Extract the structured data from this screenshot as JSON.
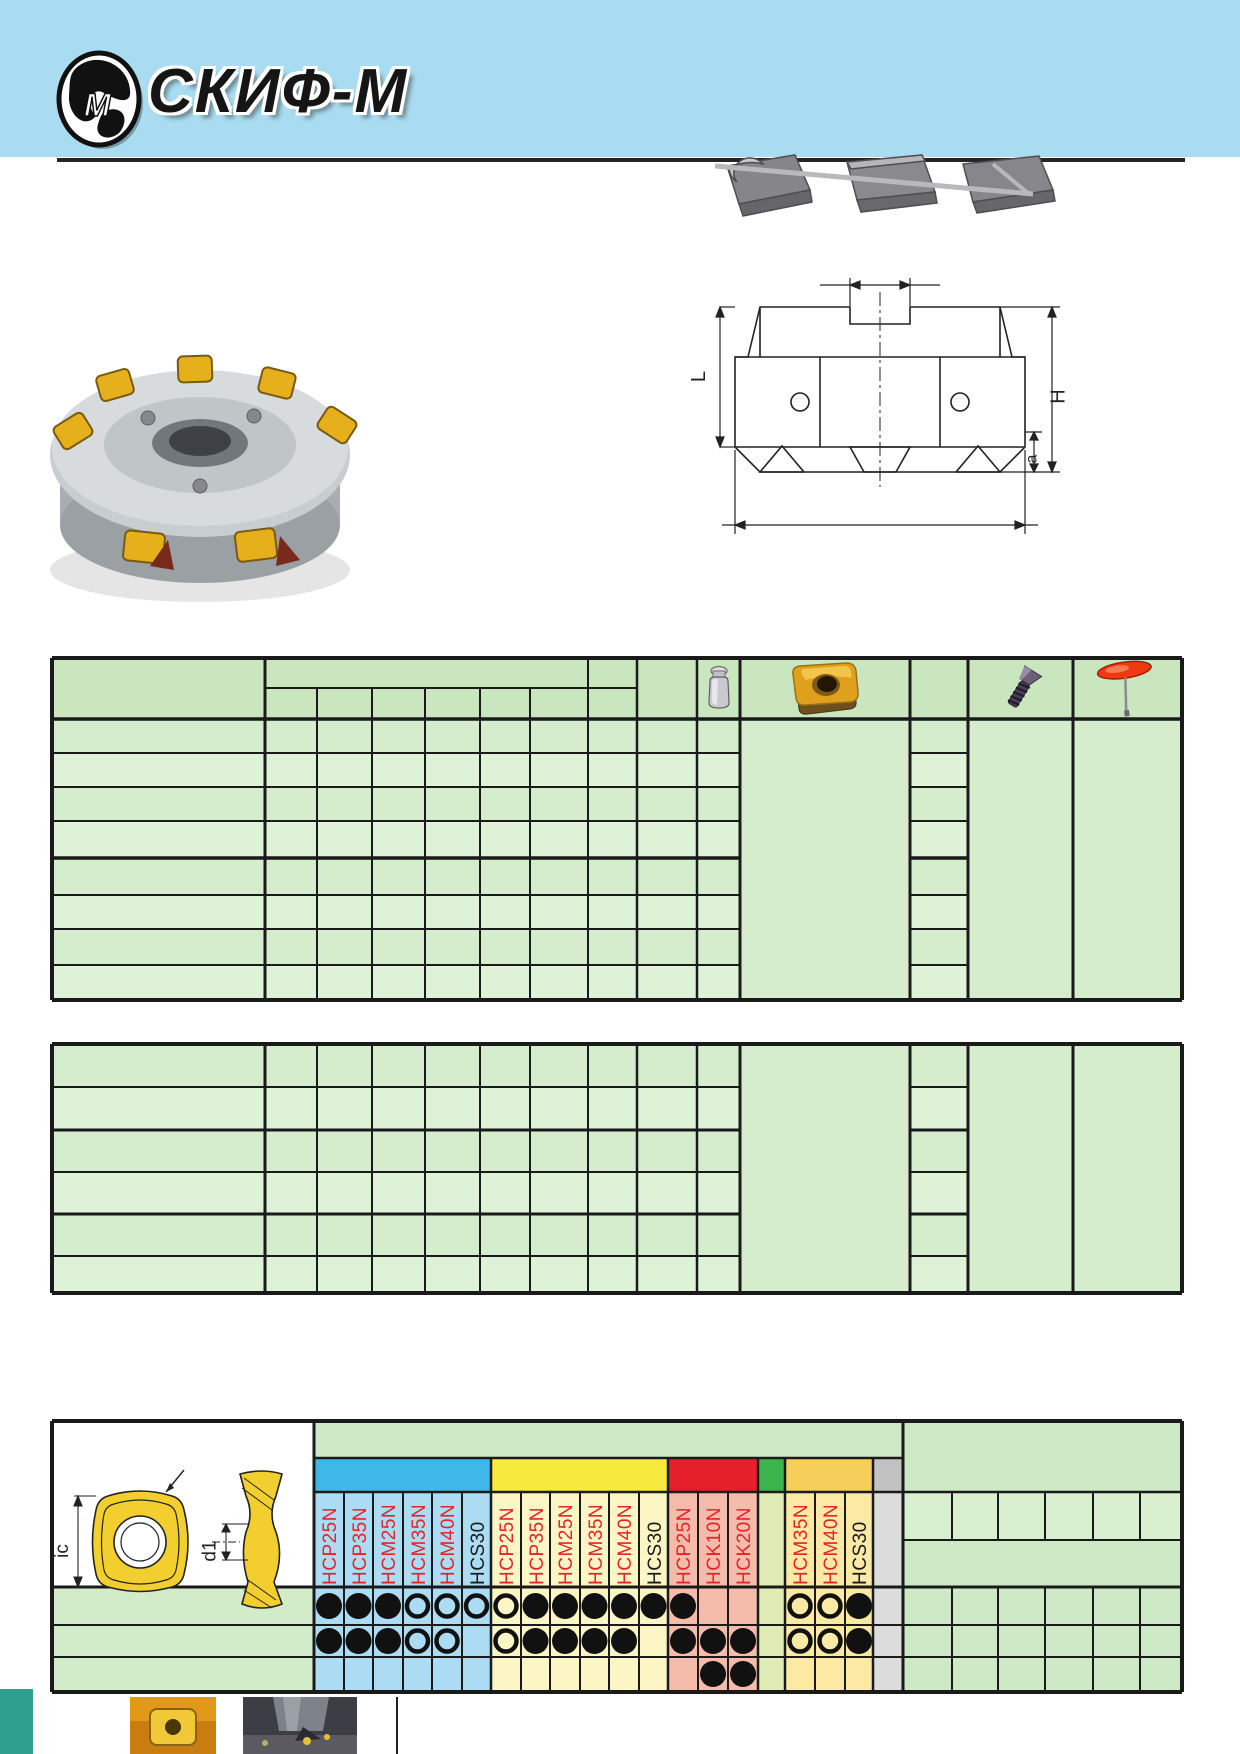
{
  "header": {
    "title": "СКИФ-М",
    "logo_letter": "M"
  },
  "images": {
    "carbide_inserts_photo": "three-carbide-inserts",
    "face_mill_photo": "face-mill-with-gold-inserts",
    "action_photo": "milling-in-action",
    "insert_photo_small": "square-gold-insert"
  },
  "tech_drawing": {
    "labels": {
      "L": "L",
      "H": "H",
      "a": "a"
    }
  },
  "insert_drawing": {
    "labels": {
      "ic": "ic",
      "d1": "d1"
    }
  },
  "table1": {
    "header_icons": [
      "weight-icon",
      "insert-photo-icon",
      "clamp-screw-icon",
      "torx-key-icon"
    ],
    "data_rows": 8
  },
  "table2": {
    "data_rows": 6
  },
  "grades_table": {
    "mark_legend": {
      "F": "filled-circle",
      "O": "open-circle",
      "": "none"
    },
    "black_label_grades": [
      "HCS30"
    ],
    "groups": [
      {
        "name": "blue",
        "band_color": "#3eb8e9",
        "cell_color": "#abdcf3",
        "grades": [
          "HCP25N",
          "HCP35N",
          "HCM25N",
          "HCM35N",
          "HCM40N",
          "HCS30"
        ]
      },
      {
        "name": "yellow",
        "band_color": "#f7ea3d",
        "cell_color": "#fbf6c3",
        "grades": [
          "HCP25N",
          "HCP35N",
          "HCM25N",
          "HCM35N",
          "HCM40N",
          "HCS30"
        ]
      },
      {
        "name": "red",
        "band_color": "#e5202b",
        "cell_color": "#f5bcab",
        "grades": [
          "HCP25N",
          "HCK10N",
          "HCK20N"
        ]
      },
      {
        "name": "green",
        "band_color": "#3cb64c",
        "cell_color": "#e0ecb6",
        "grades": [
          ""
        ]
      },
      {
        "name": "tan",
        "band_color": "#f6cf5b",
        "cell_color": "#fbe9a4",
        "grades": [
          "HCM35N",
          "HCM40N",
          "HCS30"
        ]
      },
      {
        "name": "gray",
        "band_color": "#c2c2c2",
        "cell_color": "#dcdcdc",
        "grades": [
          ""
        ]
      }
    ],
    "rows": [
      [
        "F",
        "F",
        "F",
        "O",
        "O",
        "O",
        "O",
        "F",
        "F",
        "F",
        "F",
        "F",
        "F",
        "",
        "",
        "",
        "O",
        "O",
        "F",
        ""
      ],
      [
        "F",
        "F",
        "F",
        "O",
        "O",
        "",
        "O",
        "F",
        "F",
        "F",
        "F",
        "",
        "F",
        "F",
        "F",
        "",
        "O",
        "O",
        "F",
        ""
      ],
      [
        "",
        "",
        "",
        "",
        "",
        "",
        "",
        "",
        "",
        "",
        "",
        "",
        "",
        "F",
        "F",
        "",
        "",
        "",
        "",
        ""
      ]
    ]
  }
}
